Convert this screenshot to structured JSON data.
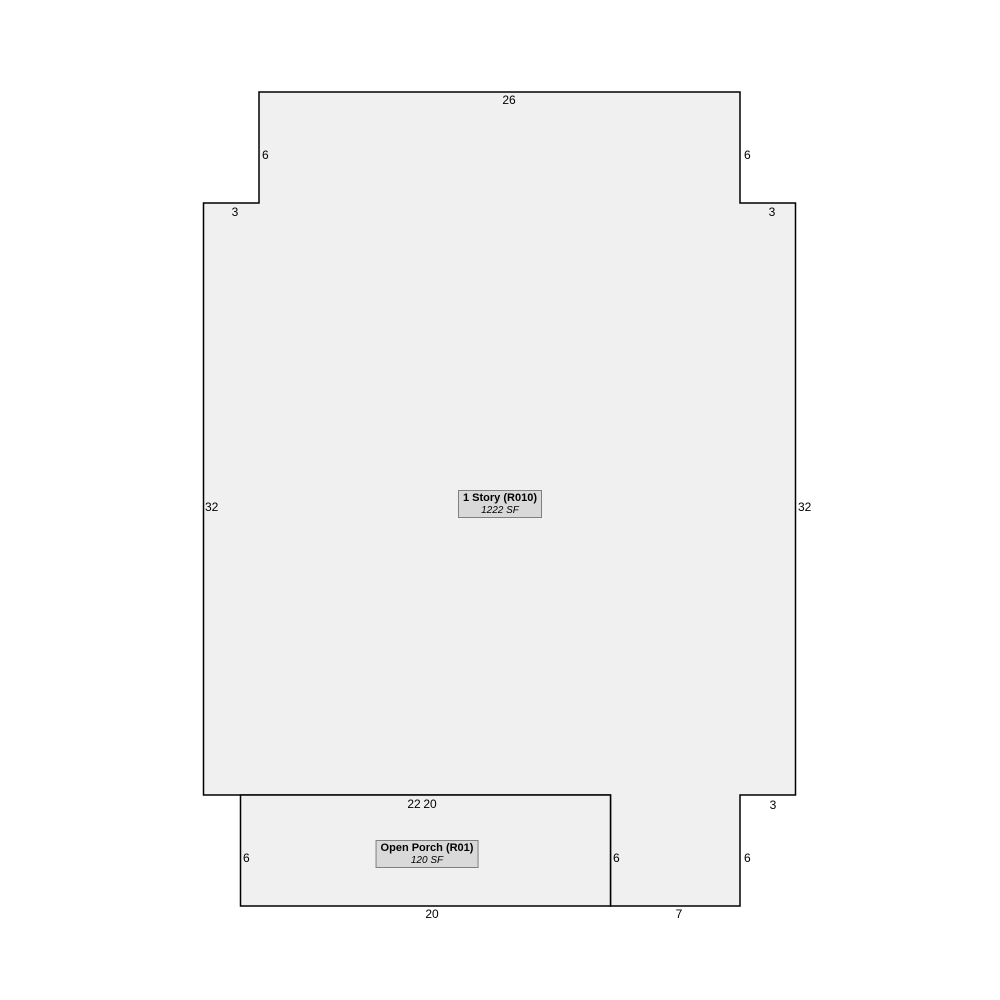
{
  "colors": {
    "background": "#ffffff",
    "shape-fill": "#f0f0f0",
    "outline": "#000000",
    "label-box-fill": "#d9d9d9",
    "label-box-border": "#7f7f7f",
    "text": "#000000"
  },
  "sketch": {
    "units": "ft",
    "scale_px_per_ft": 18.5,
    "origin_px": {
      "x": 203.5,
      "y": 92
    },
    "areas": [
      {
        "id": "main",
        "title": "1 Story (R010)",
        "area": "1222 SF",
        "vertices_ft": [
          [
            3,
            0
          ],
          [
            29,
            0
          ],
          [
            29,
            6
          ],
          [
            32,
            6
          ],
          [
            32,
            38
          ],
          [
            29,
            38
          ],
          [
            29,
            44
          ],
          [
            22,
            44
          ],
          [
            22,
            38
          ],
          [
            0,
            38
          ],
          [
            0,
            6
          ],
          [
            3,
            6
          ]
        ],
        "label_center_px": {
          "x": 500,
          "y": 504
        }
      },
      {
        "id": "porch",
        "title": "Open Porch (R01)",
        "area": "120 SF",
        "vertices_ft": [
          [
            2,
            38
          ],
          [
            22,
            38
          ],
          [
            22,
            44
          ],
          [
            2,
            44
          ]
        ],
        "label_center_px": {
          "x": 427,
          "y": 854
        }
      }
    ],
    "dimensions": [
      {
        "id": "top-width",
        "text": "26",
        "x": 509,
        "y": 93,
        "align": "center"
      },
      {
        "id": "upper-left-height",
        "text": "6",
        "x": 262,
        "y": 148,
        "align": "left"
      },
      {
        "id": "upper-right-height",
        "text": "6",
        "x": 744,
        "y": 148,
        "align": "left"
      },
      {
        "id": "upper-left-step",
        "text": "3",
        "x": 235,
        "y": 205,
        "align": "center"
      },
      {
        "id": "upper-right-step",
        "text": "3",
        "x": 772,
        "y": 205,
        "align": "center"
      },
      {
        "id": "left-height",
        "text": "32",
        "x": 205,
        "y": 500,
        "align": "left"
      },
      {
        "id": "right-height",
        "text": "32",
        "x": 798,
        "y": 500,
        "align": "left"
      },
      {
        "id": "bottom-left-width",
        "text": "22",
        "x": 414,
        "y": 797,
        "align": "center"
      },
      {
        "id": "porch-top-width",
        "text": "20",
        "x": 430,
        "y": 797,
        "align": "center"
      },
      {
        "id": "bottom-right-step",
        "text": "3",
        "x": 773,
        "y": 798,
        "align": "center"
      },
      {
        "id": "porch-left-height",
        "text": "6",
        "x": 243,
        "y": 851,
        "align": "left"
      },
      {
        "id": "porch-right-height",
        "text": "6",
        "x": 613,
        "y": 851,
        "align": "left"
      },
      {
        "id": "extension-right-height",
        "text": "6",
        "x": 744,
        "y": 851,
        "align": "left"
      },
      {
        "id": "porch-bottom-width",
        "text": "20",
        "x": 432,
        "y": 907,
        "align": "center"
      },
      {
        "id": "extension-bottom-width",
        "text": "7",
        "x": 679,
        "y": 907,
        "align": "center"
      }
    ]
  }
}
